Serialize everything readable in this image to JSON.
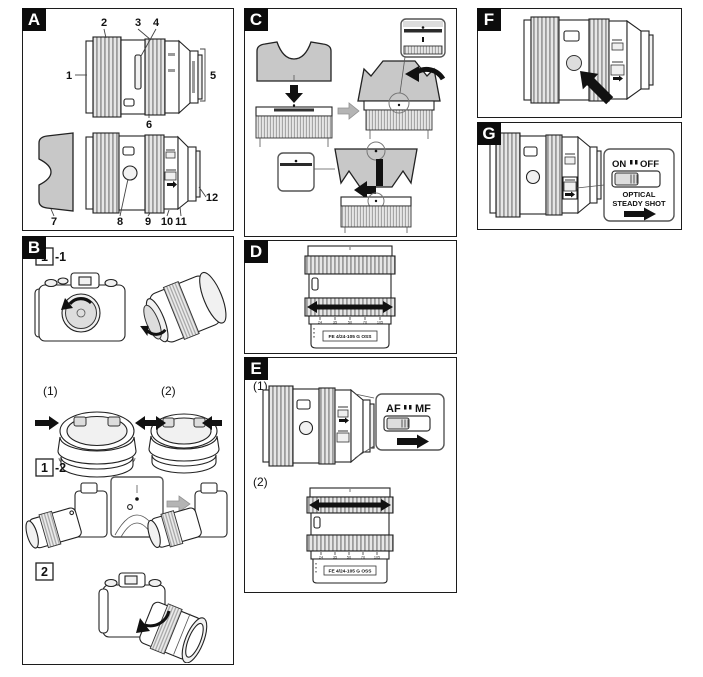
{
  "document": {
    "type": "lens-instruction-manual-page",
    "background": "#ffffff",
    "line_color": "#1c1c1c"
  },
  "panels": {
    "a": {
      "label": "A",
      "callouts": [
        "1",
        "2",
        "3",
        "4",
        "5",
        "6",
        "7",
        "8",
        "9",
        "10",
        "11",
        "12"
      ]
    },
    "b": {
      "label": "B",
      "steps": {
        "s1_box": "1",
        "s1_suffix": "-1",
        "sub1": "(1)",
        "sub2": "(2)",
        "s2_box": "1",
        "s2_suffix": "-2",
        "s3_box": "2"
      }
    },
    "c": {
      "label": "C"
    },
    "d": {
      "label": "D",
      "lens_marking": "FE 4/24-105 G OSS",
      "zoom_scale": [
        "24",
        "35",
        "50",
        "70",
        "105"
      ]
    },
    "e": {
      "label": "E",
      "sub1": "(1)",
      "sub2": "(2)",
      "switch": {
        "left": "AF",
        "right": "MF"
      },
      "lens_marking": "FE 4/24-105 G OSS",
      "zoom_scale": [
        "24",
        "35",
        "50",
        "70",
        "105"
      ]
    },
    "f": {
      "label": "F"
    },
    "g": {
      "label": "G",
      "switch": {
        "left": "ON",
        "right": "OFF"
      },
      "name_line1": "OPTICAL",
      "name_line2": "STEADY SHOT"
    }
  }
}
